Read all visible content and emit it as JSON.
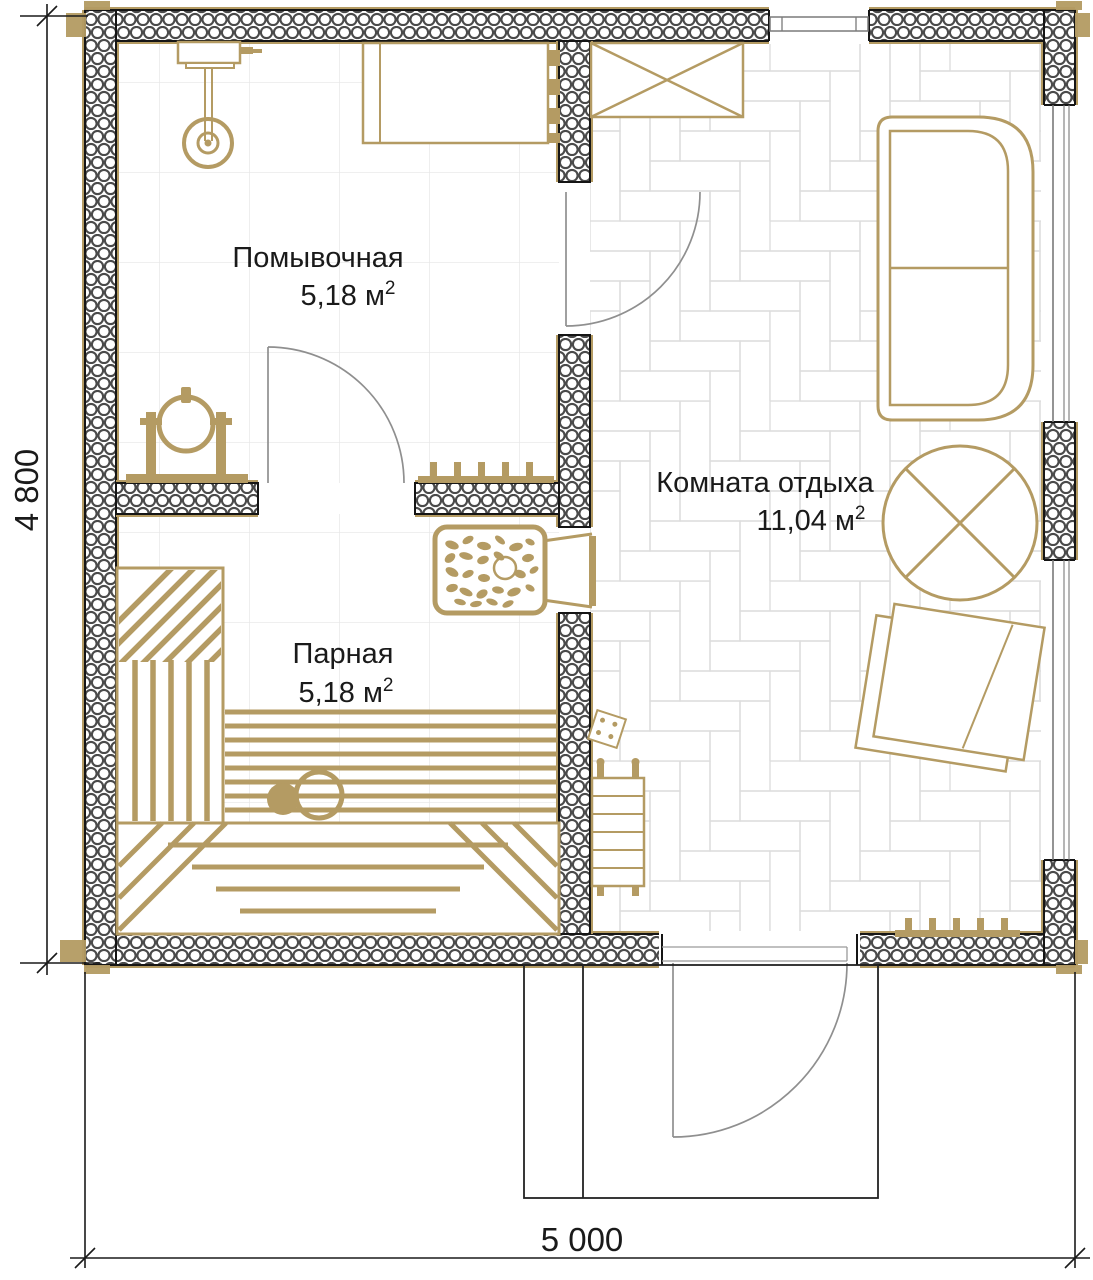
{
  "rooms": {
    "washing": {
      "name": "Помывочная",
      "area": "5,18 м",
      "area_sup": "2"
    },
    "steam": {
      "name": "Парная",
      "area": "5,18 м",
      "area_sup": "2"
    },
    "lounge": {
      "name": "Комната отдыха",
      "area": "11,04 м",
      "area_sup": "2"
    }
  },
  "dimensions": {
    "height": "4 800",
    "width": "5 000"
  },
  "colors": {
    "wood": "#b49b63",
    "wall_line": "#151515",
    "hatch": "#4a4a4a",
    "door_arc": "#8f8f8f",
    "floor_grid": "#e6e6e6",
    "parquet": "#dcdcdc",
    "text": "#1a1a1a"
  }
}
